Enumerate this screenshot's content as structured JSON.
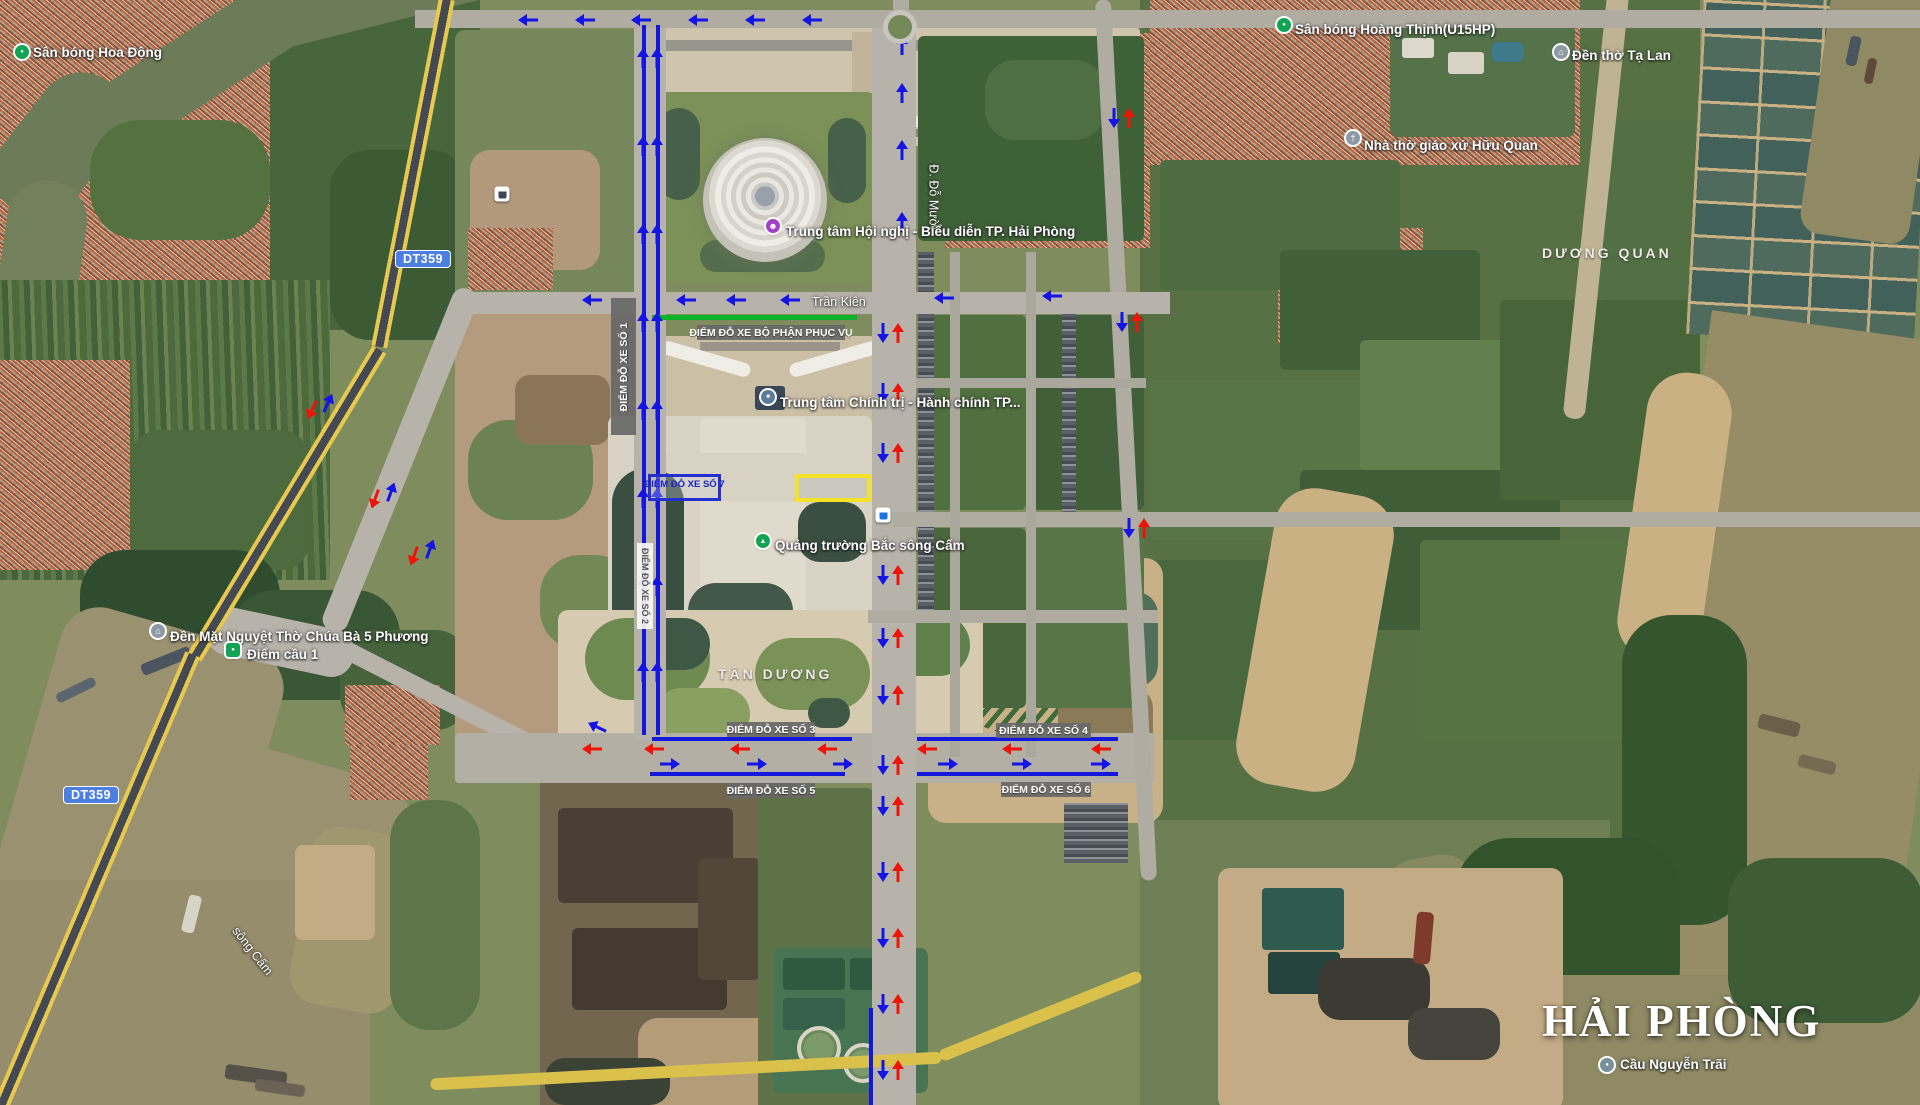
{
  "watermark": {
    "title": "HẢI PHÒNG"
  },
  "road_badges": [
    {
      "text": "DT359",
      "x": 423,
      "y": 259
    },
    {
      "text": "DT359",
      "x": 91,
      "y": 795
    }
  ],
  "locality_labels": [
    {
      "text": "DƯƠNG QUAN",
      "x": 1542,
      "y": 245
    },
    {
      "text": "TÂN DƯƠNG",
      "x": 718,
      "y": 666
    }
  ],
  "road_labels": [
    {
      "text": "Trần Kiên",
      "x": 812,
      "y": 295,
      "rot": 0
    },
    {
      "text": "Đ. Đỗ Mười",
      "x": 901,
      "y": 190,
      "rot": 90
    },
    {
      "text": "sông Cấm",
      "x": 224,
      "y": 944,
      "rot": 52
    }
  ],
  "poi": [
    {
      "label": "Sân bóng Hoa Động",
      "icon": "dot-green",
      "glyph": "●",
      "ix": 22,
      "iy": 52,
      "tx": 33,
      "ty": 45
    },
    {
      "label": "Sân bóng Hoàng Thịnh(U15HP)",
      "icon": "dot-green",
      "glyph": "●",
      "ix": 1284,
      "iy": 25,
      "tx": 1295,
      "ty": 22
    },
    {
      "label": "Đền thờ Tạ Lan",
      "icon": "temple-gray",
      "glyph": "⌂",
      "ix": 1561,
      "iy": 52,
      "tx": 1572,
      "ty": 48
    },
    {
      "label": "Nhà thờ giáo xứ Hữu Quan",
      "icon": "church-gray",
      "glyph": "†",
      "ix": 1353,
      "iy": 138,
      "tx": 1364,
      "ty": 138
    },
    {
      "label": "Trung tâm Hội nghị  -  Biểu diễn TP. Hải Phòng",
      "icon": "theater-purple",
      "glyph": "☻",
      "ix": 773,
      "iy": 226,
      "tx": 786,
      "ty": 224
    },
    {
      "label": "Trung tâm Chính trị - Hành chính TP...",
      "icon": "building-slate",
      "glyph": "■",
      "ix": 768,
      "iy": 397,
      "tx": 780,
      "ty": 395
    },
    {
      "label": "Quảng trường Bắc sông Cấm",
      "icon": "tree-green",
      "glyph": "▲",
      "ix": 763,
      "iy": 541,
      "tx": 775,
      "ty": 538
    },
    {
      "label": "Đền Mặt Nguyệt Thờ Chúa Bà 5 Phương",
      "icon": "temple-gray",
      "glyph": "⌂",
      "ix": 158,
      "iy": 631,
      "tx": 170,
      "ty": 629
    },
    {
      "label": "Điểm cầu 1",
      "icon": "pin-green",
      "glyph": "●",
      "ix": 233,
      "iy": 650,
      "tx": 247,
      "ty": 647
    },
    {
      "label": "Cầu Nguyễn Trãi",
      "icon": "dot-gray",
      "glyph": "●",
      "ix": 1607,
      "iy": 1065,
      "tx": 1620,
      "ty": 1057
    }
  ],
  "parking_labels": [
    {
      "text": "ĐIỂM ĐỖ XE SỐ 1",
      "x": 611,
      "y": 298,
      "w": 25,
      "h": 137,
      "style": "dark",
      "rot": -90
    },
    {
      "text": "ĐIỂM ĐỖ XE SỐ 2",
      "x": 637,
      "y": 543,
      "w": 16,
      "h": 86,
      "style": "light",
      "rot": 90
    },
    {
      "text": "ĐIỂM ĐỖ XE BỘ PHẬN PHỤC VỤ",
      "x": 697,
      "y": 325,
      "w": 148,
      "h": 15,
      "style": "dark",
      "rot": 0
    },
    {
      "text": "ĐIỂM ĐỖ XE SỐ 3",
      "x": 727,
      "y": 722,
      "w": 88,
      "h": 15,
      "style": "dark",
      "rot": 0
    },
    {
      "text": "ĐIỂM ĐỖ XE SỐ 4",
      "x": 996,
      "y": 723,
      "w": 95,
      "h": 15,
      "style": "dark",
      "rot": 0
    },
    {
      "text": "ĐIỂM ĐỖ XE SỐ 5",
      "x": 727,
      "y": 783,
      "w": 88,
      "h": 15,
      "style": "dark",
      "rot": 0
    },
    {
      "text": "ĐIỂM ĐỖ XE SỐ  6",
      "x": 1001,
      "y": 782,
      "w": 90,
      "h": 15,
      "style": "dark",
      "rot": 0
    },
    {
      "text": "ĐIỂM ĐỖ XE SỐ 7",
      "x": 648,
      "y": 474,
      "w": 73,
      "h": 27,
      "style": "blue",
      "rot": 0
    }
  ],
  "highlight_rect": {
    "x": 795,
    "y": 474,
    "w": 76,
    "h": 28
  },
  "service_line": {
    "x": 652,
    "y": 315,
    "len": 205
  },
  "colors": {
    "arrow_blue": "#1514e6",
    "arrow_red": "#ee1407",
    "line_blue": "#1417dc",
    "service_green": "#0db12b"
  },
  "blue_lines": [
    {
      "x": 652,
      "y": 737,
      "len": 200,
      "o": "h"
    },
    {
      "x": 917,
      "y": 737,
      "len": 201,
      "o": "h"
    },
    {
      "x": 650,
      "y": 772,
      "len": 195,
      "o": "h"
    },
    {
      "x": 917,
      "y": 772,
      "len": 201,
      "o": "h"
    },
    {
      "x": 642,
      "y": 25,
      "len": 710,
      "o": "v"
    },
    {
      "x": 656,
      "y": 25,
      "len": 710,
      "o": "v"
    },
    {
      "x": 869,
      "y": 1008,
      "len": 97,
      "o": "v"
    }
  ],
  "arrows": [
    [
      528,
      20,
      "l",
      "b"
    ],
    [
      585,
      20,
      "l",
      "b"
    ],
    [
      641,
      20,
      "l",
      "b"
    ],
    [
      698,
      20,
      "l",
      "b"
    ],
    [
      755,
      20,
      "l",
      "b"
    ],
    [
      812,
      20,
      "l",
      "b"
    ],
    [
      643,
      58,
      "u",
      "b"
    ],
    [
      657,
      58,
      "u",
      "b"
    ],
    [
      643,
      146,
      "u",
      "b"
    ],
    [
      657,
      146,
      "u",
      "b"
    ],
    [
      643,
      234,
      "u",
      "b"
    ],
    [
      657,
      234,
      "u",
      "b"
    ],
    [
      643,
      322,
      "u",
      "b"
    ],
    [
      657,
      322,
      "u",
      "b"
    ],
    [
      643,
      410,
      "u",
      "b"
    ],
    [
      657,
      410,
      "u",
      "b"
    ],
    [
      643,
      498,
      "u",
      "b"
    ],
    [
      657,
      498,
      "u",
      "b"
    ],
    [
      643,
      586,
      "u",
      "b"
    ],
    [
      657,
      586,
      "u",
      "b"
    ],
    [
      643,
      672,
      "u",
      "b"
    ],
    [
      657,
      672,
      "u",
      "b"
    ],
    [
      592,
      300,
      "l",
      "b"
    ],
    [
      686,
      300,
      "l",
      "b"
    ],
    [
      736,
      300,
      "l",
      "b"
    ],
    [
      790,
      300,
      "l",
      "b"
    ],
    [
      944,
      298,
      "l",
      "b"
    ],
    [
      1052,
      296,
      "l",
      "b"
    ],
    [
      902,
      45,
      "u",
      "b"
    ],
    [
      902,
      93,
      "u",
      "b"
    ],
    [
      902,
      150,
      "u",
      "b"
    ],
    [
      902,
      222,
      "u",
      "b"
    ],
    [
      883,
      333,
      "d",
      "b"
    ],
    [
      898,
      333,
      "u",
      "r"
    ],
    [
      883,
      393,
      "d",
      "b"
    ],
    [
      898,
      393,
      "u",
      "r"
    ],
    [
      883,
      453,
      "d",
      "b"
    ],
    [
      898,
      453,
      "u",
      "r"
    ],
    [
      883,
      575,
      "d",
      "b"
    ],
    [
      898,
      575,
      "u",
      "r"
    ],
    [
      883,
      638,
      "d",
      "b"
    ],
    [
      898,
      638,
      "u",
      "r"
    ],
    [
      883,
      695,
      "d",
      "b"
    ],
    [
      898,
      695,
      "u",
      "r"
    ],
    [
      883,
      765,
      "d",
      "b"
    ],
    [
      898,
      765,
      "u",
      "r"
    ],
    [
      883,
      806,
      "d",
      "b"
    ],
    [
      898,
      806,
      "u",
      "r"
    ],
    [
      883,
      872,
      "d",
      "b"
    ],
    [
      898,
      872,
      "u",
      "r"
    ],
    [
      883,
      938,
      "d",
      "b"
    ],
    [
      898,
      938,
      "u",
      "r"
    ],
    [
      883,
      1004,
      "d",
      "b"
    ],
    [
      898,
      1004,
      "u",
      "r"
    ],
    [
      883,
      1070,
      "d",
      "b"
    ],
    [
      898,
      1070,
      "u",
      "r"
    ],
    [
      592,
      749,
      "l",
      "r"
    ],
    [
      654,
      749,
      "l",
      "r"
    ],
    [
      740,
      749,
      "l",
      "r"
    ],
    [
      827,
      749,
      "l",
      "r"
    ],
    [
      927,
      749,
      "l",
      "r"
    ],
    [
      1012,
      749,
      "l",
      "r"
    ],
    [
      1101,
      749,
      "l",
      "r"
    ],
    [
      670,
      764,
      "r",
      "b"
    ],
    [
      757,
      764,
      "r",
      "b"
    ],
    [
      843,
      764,
      "r",
      "b"
    ],
    [
      948,
      764,
      "r",
      "b"
    ],
    [
      1022,
      764,
      "r",
      "b"
    ],
    [
      1101,
      764,
      "r",
      "b"
    ],
    [
      375,
      499,
      "d",
      "r",
      20
    ],
    [
      391,
      492,
      "u",
      "b",
      20
    ],
    [
      414,
      556,
      "d",
      "r",
      20
    ],
    [
      430,
      549,
      "u",
      "b",
      20
    ],
    [
      312,
      410,
      "d",
      "r",
      25
    ],
    [
      328,
      403,
      "u",
      "b",
      25
    ],
    [
      1114,
      118,
      "d",
      "b"
    ],
    [
      1129,
      118,
      "u",
      "r"
    ],
    [
      1122,
      322,
      "d",
      "b"
    ],
    [
      1137,
      322,
      "u",
      "r"
    ],
    [
      1129,
      528,
      "d",
      "b"
    ],
    [
      1144,
      528,
      "u",
      "r"
    ],
    [
      597,
      727,
      "l",
      "b",
      25
    ]
  ],
  "transit_stops": [
    {
      "x": 502,
      "y": 194,
      "color": "#3d4854"
    },
    {
      "x": 883,
      "y": 515,
      "color": "#1a73e8"
    }
  ],
  "roundabout": {
    "x": 900,
    "y": 27
  }
}
